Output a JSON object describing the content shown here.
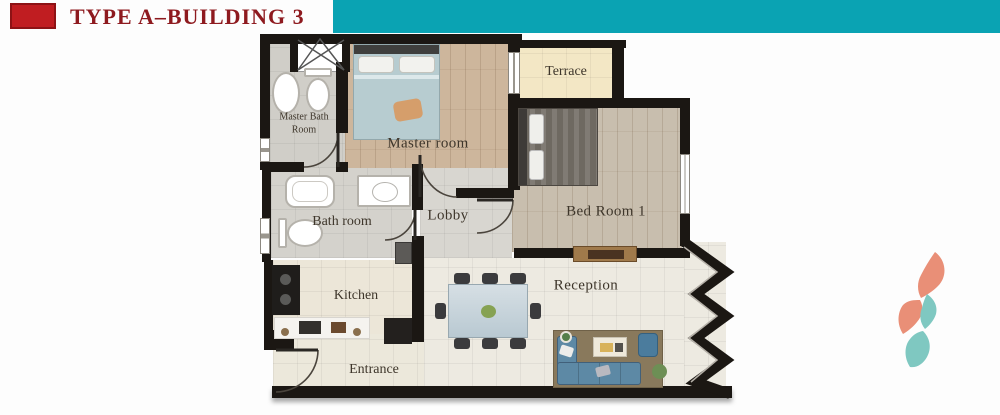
{
  "header": {
    "title": "TYPE A–BUILDING 3"
  },
  "floor_plan": {
    "rooms": [
      {
        "key": "master_room",
        "label": "Master room"
      },
      {
        "key": "terrace",
        "label": "Terrace"
      },
      {
        "key": "bed_room_1",
        "label": "Bed Room 1"
      },
      {
        "key": "master_bath_room",
        "label": "Master Bath Room"
      },
      {
        "key": "bath_room",
        "label": "Bath room"
      },
      {
        "key": "lobby",
        "label": "Lobby"
      },
      {
        "key": "kitchen",
        "label": "Kitchen"
      },
      {
        "key": "entrance",
        "label": "Entrance"
      },
      {
        "key": "reception",
        "label": "Reception"
      }
    ]
  },
  "colors": {
    "accent_teal": "#0aa3b3",
    "accent_red": "#c01d21",
    "title_text": "#8e1a1f",
    "wall": "#1b1713",
    "logo_salmon": "#e98f77",
    "logo_teal": "#7fc8c1"
  }
}
